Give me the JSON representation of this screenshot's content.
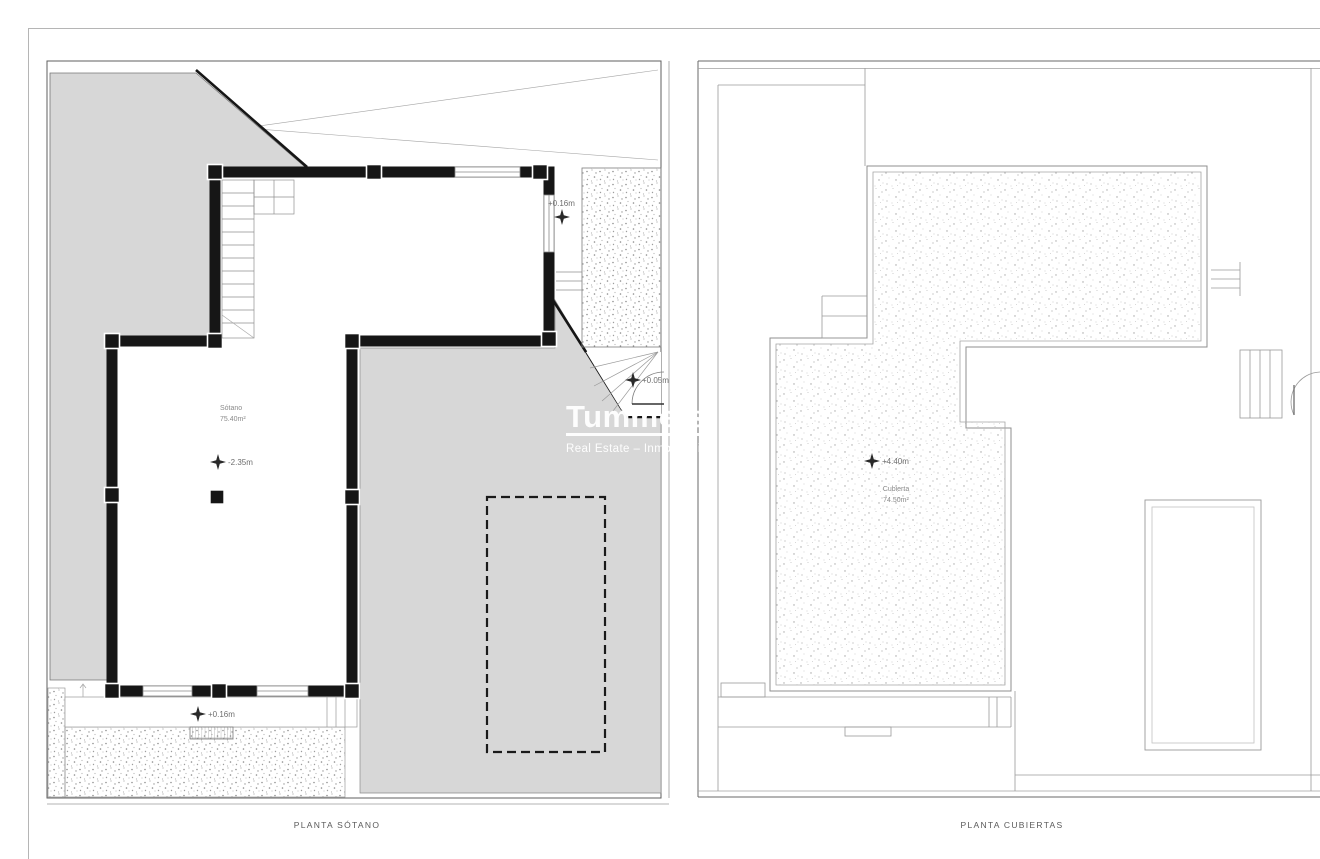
{
  "watermark": {
    "brand": "Tummers",
    "tagline": "Real Estate – Inmobiliaria –"
  },
  "left_plan": {
    "caption": "PLANTA SÓTANO",
    "room": {
      "name": "Sótano",
      "area": "75.40m²"
    },
    "levels": {
      "terrace_upper": "+0.16m",
      "basement_floor": "-2.35m",
      "side_entry": "+0.05m",
      "front_entry": "+0.16m"
    }
  },
  "right_plan": {
    "caption": "PLANTA CUBIERTAS",
    "room": {
      "name": "Cubierta",
      "area": "74.50m²"
    },
    "levels": {
      "roof": "+4.40m"
    }
  },
  "colors": {
    "site_fill": "#d7d7d7",
    "wall": "#161616",
    "thin_line": "#5f5f5f",
    "roof_line": "#8f8f8f"
  }
}
